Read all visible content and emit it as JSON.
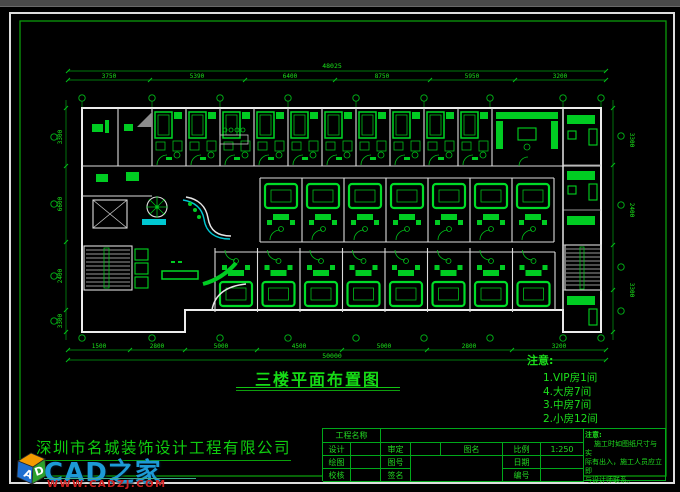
{
  "colors": {
    "line_green": "#00d41e",
    "wall_white": "#ececec",
    "cyan_accent": "#00c8d2",
    "logo_blue": "#1d9ad6",
    "url_red": "#cf2020"
  },
  "watermark": {
    "site_name": "CAD之家",
    "site_url": "WWW.CADZJ.COM",
    "cube_letter_a": "A",
    "cube_letter_d": "D"
  },
  "company": {
    "name": "深圳市名城装饰设计工程有限公司"
  },
  "drawing": {
    "title": "三楼平面布置图",
    "legend": {
      "heading": "注意:",
      "items": [
        "1.VIP房1间",
        "4.大房7间",
        "3.中房7间",
        "2.小房12间"
      ]
    },
    "dims": {
      "top_total": "48025",
      "top": [
        "3750",
        "5390",
        "6400",
        "8750",
        "5950",
        "3200"
      ],
      "bottom": [
        "1500",
        "2800",
        "5000",
        "4500",
        "5000",
        "2800",
        "3200"
      ],
      "bottom_total": "50000",
      "left": [
        "3300",
        "6600",
        "2400",
        "3300"
      ],
      "right": [
        "3300",
        "2400",
        "3300"
      ]
    }
  },
  "title_block": {
    "project_label": "工程名称",
    "design_label": "设计",
    "review_label": "审定",
    "drawname_label": "图名",
    "scale_label": "比例",
    "scale_value": "1:250",
    "draft_label": "绘图",
    "sheetno_label": "图号",
    "date_label": "日期",
    "check_label": "校核",
    "sign_label": "签名",
    "serial_label": "编号",
    "note_heading": "注意:",
    "note_line1": "施工时如图纸尺寸与实",
    "note_line2": "际有出入，施工人员应立即",
    "note_line3": "与设计师联系。"
  }
}
